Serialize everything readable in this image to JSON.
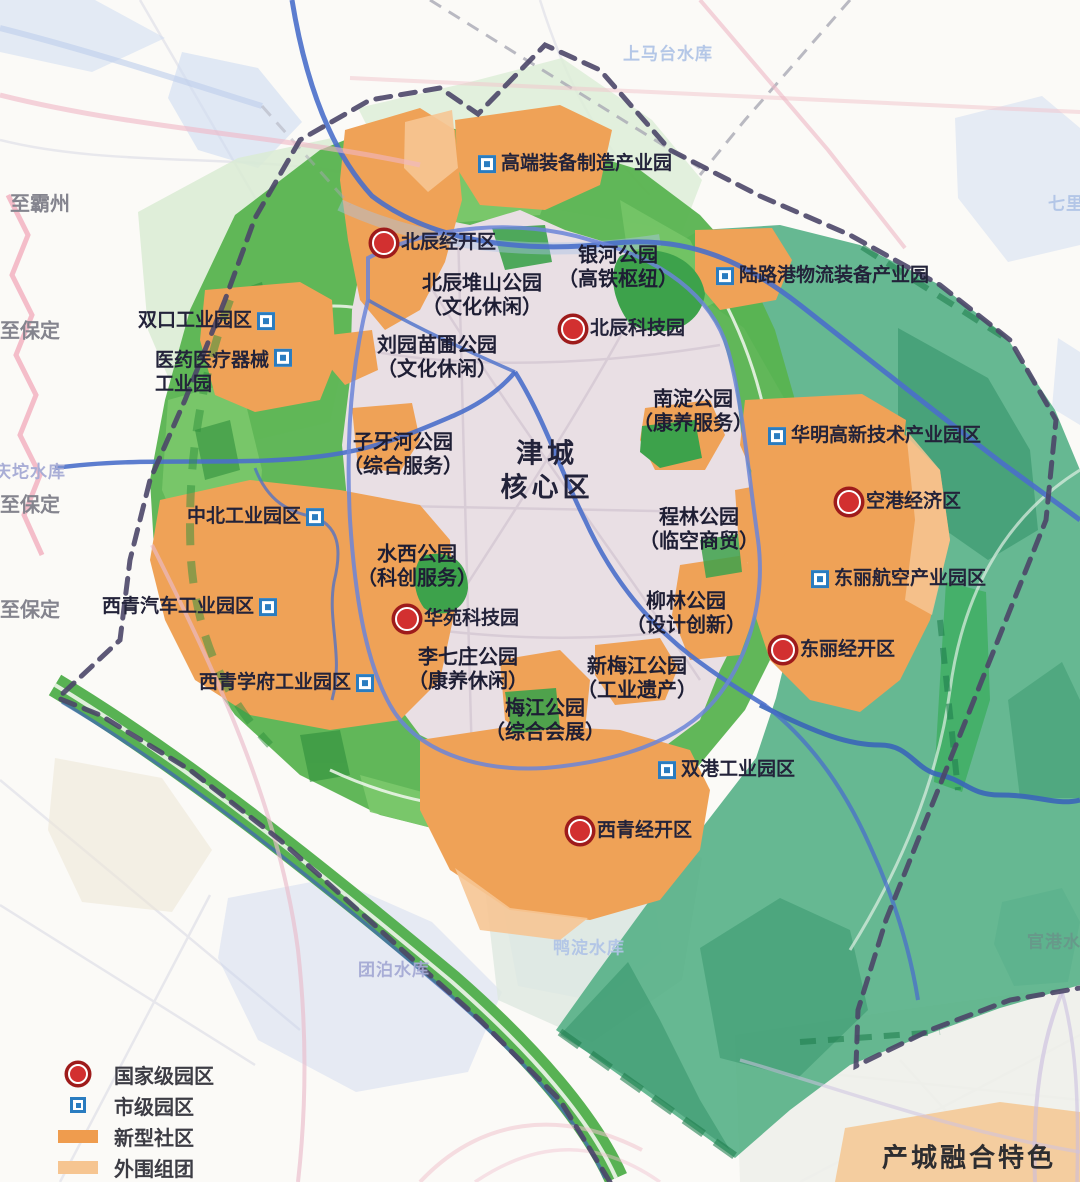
{
  "map": {
    "core_area": {
      "line1": "津城",
      "line2": "核心区",
      "x": 547,
      "y": 471
    },
    "national_parks": [
      {
        "name": "北辰经开区",
        "x": 386,
        "y": 243
      },
      {
        "name": "北辰科技园",
        "x": 575,
        "y": 329
      },
      {
        "name": "空港经济区",
        "x": 851,
        "y": 502
      },
      {
        "name": "华苑科技园",
        "x": 409,
        "y": 619
      },
      {
        "name": "东丽经开区",
        "x": 785,
        "y": 650
      },
      {
        "name": "西青经开区",
        "x": 582,
        "y": 831
      }
    ],
    "city_parks": [
      {
        "name": "高端装备制造产业园",
        "x": 492,
        "y": 164,
        "side": "right"
      },
      {
        "name": "陆路港物流装备产业园",
        "x": 730,
        "y": 276,
        "side": "right"
      },
      {
        "name": "双口工业园区",
        "x": 261,
        "y": 321,
        "side": "left"
      },
      {
        "name": "医药医疗器械",
        "name2": "工业园",
        "x": 278,
        "y": 364,
        "side": "left"
      },
      {
        "name": "华明高新技术产业园区",
        "x": 782,
        "y": 436,
        "side": "right"
      },
      {
        "name": "中北工业园区",
        "x": 310,
        "y": 517,
        "side": "left"
      },
      {
        "name": "东丽航空产业园区",
        "x": 825,
        "y": 579,
        "side": "right"
      },
      {
        "name": "西青汽车工业园区",
        "x": 263,
        "y": 607,
        "side": "left"
      },
      {
        "name": "西青学府工业园区",
        "x": 360,
        "y": 683,
        "side": "left"
      },
      {
        "name": "双港工业园区",
        "x": 672,
        "y": 770,
        "side": "right"
      }
    ],
    "park_labels": [
      {
        "line1": "北辰堆山公园",
        "line2": "（文化休闲）",
        "x": 482,
        "y": 296
      },
      {
        "line1": "银河公园",
        "line2": "（高铁枢纽）",
        "x": 618,
        "y": 268
      },
      {
        "line1": "刘园苗圃公园",
        "line2": "（文化休闲）",
        "x": 437,
        "y": 358
      },
      {
        "line1": "南淀公园",
        "line2": "（康养服务）",
        "x": 693,
        "y": 412
      },
      {
        "line1": "子牙河公园",
        "line2": "（综合服务）",
        "x": 403,
        "y": 455
      },
      {
        "line1": "程林公园",
        "line2": "（临空商贸）",
        "x": 699,
        "y": 530
      },
      {
        "line1": "水西公园",
        "line2": "（科创服务）",
        "x": 417,
        "y": 567
      },
      {
        "line1": "柳林公园",
        "line2": "（设计创新）",
        "x": 686,
        "y": 614
      },
      {
        "line1": "李七庄公园",
        "line2": "（康养休闲）",
        "x": 468,
        "y": 670
      },
      {
        "line1": "新梅江公园",
        "line2": "（工业遗产）",
        "x": 637,
        "y": 679
      },
      {
        "line1": "梅江公园",
        "line2": "（综合会展）",
        "x": 545,
        "y": 721
      }
    ],
    "edge_labels": [
      {
        "text": "至霸州",
        "x": 10,
        "y": 202
      },
      {
        "text": "至保定",
        "x": 0,
        "y": 329
      },
      {
        "text": "至保定",
        "x": 0,
        "y": 503
      },
      {
        "text": "至保定",
        "x": 0,
        "y": 608
      }
    ],
    "water_labels": [
      {
        "text": "上马台水库",
        "x": 668,
        "y": 52,
        "tone": "lightblue"
      },
      {
        "text": "七里海",
        "x": 1075,
        "y": 202,
        "tone": "lightblue"
      },
      {
        "text": "庆坨水库",
        "x": 30,
        "y": 470,
        "tone": "purple"
      },
      {
        "text": "团泊水库",
        "x": 394,
        "y": 968,
        "tone": "purple"
      },
      {
        "text": "鸭淀水库",
        "x": 589,
        "y": 946,
        "tone": "lightblue"
      },
      {
        "text": "官港水库",
        "x": 1063,
        "y": 940,
        "tone": "teal"
      }
    ],
    "legend": {
      "items": [
        {
          "label": "国家级园区",
          "type": "red-circle"
        },
        {
          "label": "市级园区",
          "type": "blue-square"
        },
        {
          "label": "新型社区",
          "type": "orange-bar"
        },
        {
          "label": "外围组团",
          "type": "light-orange-bar"
        }
      ]
    },
    "caption": "产城融合特色",
    "colors": {
      "national_marker": "#d23030",
      "national_marker_ring": "#9e1b1b",
      "city_marker": "#2a7cc0",
      "new_community_orange": "#ef9c4e",
      "outer_cluster_orange": "#f6c591",
      "eco_ring_green": "#58b350",
      "regional_teal_green": "#55b086",
      "core_fill": "#e9dfe4",
      "river_blue": "#4a6fca",
      "boundary_dash": "#4b4668"
    }
  }
}
